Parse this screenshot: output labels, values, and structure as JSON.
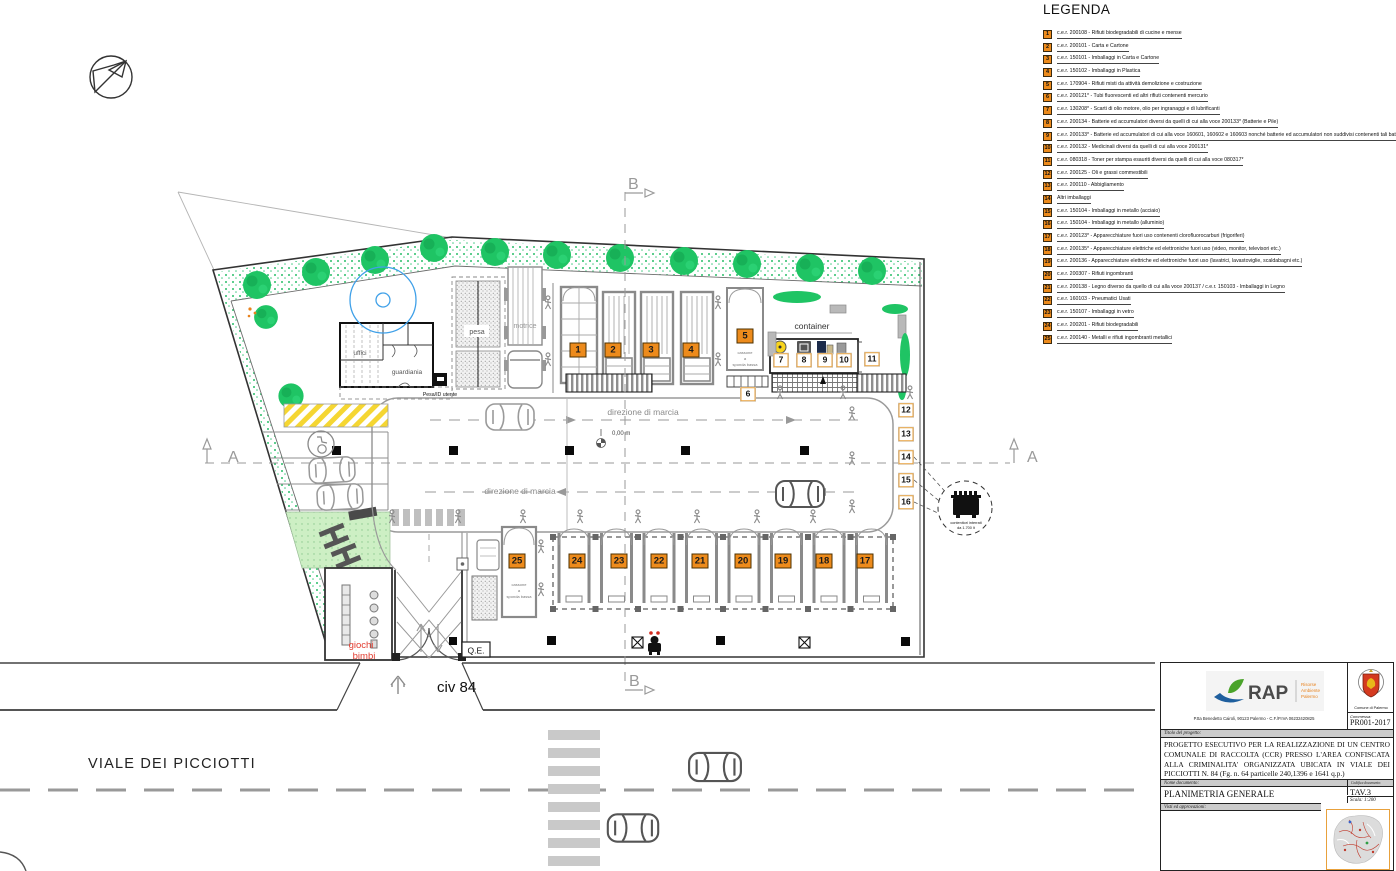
{
  "legend": {
    "title": "LEGENDA",
    "items": [
      {
        "num": "1",
        "text": "c.e.r. 200108 - Rifiuti biodegradabili di cucine e mense"
      },
      {
        "num": "2",
        "text": "c.e.r. 200101 - Carta e Cartone"
      },
      {
        "num": "3",
        "text": "c.e.r. 150101 - Imballaggi in Carta e Cartone"
      },
      {
        "num": "4",
        "text": "c.e.r. 150102 - Imballaggi in Plastica"
      },
      {
        "num": "5",
        "text": "c.e.r. 170904 - Rifiuti misti da attività demolizione e costruzione"
      },
      {
        "num": "6",
        "text": "c.e.r. 200121* - Tubi fluorescenti ed altri rifiuti contenenti mercurio"
      },
      {
        "num": "7",
        "text": "c.e.r. 130208* - Scarti di olio motore, olio per ingranaggi e di lubrificanti"
      },
      {
        "num": "8",
        "text": "c.e.r. 200134 - Batterie ed accumulatori diversi da quelli di cui alla voce 200133* (Batterie e Pile)"
      },
      {
        "num": "9",
        "text": "c.e.r. 200133* - Batterie ed accumulatori di cui alla voce 160601, 160602 e 160603 nonché batterie ed accumulatori non suddivisi contenenti tali batterie"
      },
      {
        "num": "10",
        "text": "c.e.r. 200132 - Medicinali diversi da quelli di cui alla voce 200131*"
      },
      {
        "num": "11",
        "text": "c.e.r. 080318 - Toner per stampa esauriti diversi da quelli di cui alla voce 080317*"
      },
      {
        "num": "12",
        "text": "c.e.r. 200125 - Oli e grassi commestibili"
      },
      {
        "num": "13",
        "text": "c.e.r. 200110 - Abbigliamento"
      },
      {
        "num": "14",
        "text": "Altri imballaggi"
      },
      {
        "num": "15",
        "text": "c.e.r. 150104 - Imballaggi in metallo (acciaio)"
      },
      {
        "num": "16",
        "text": "c.e.r. 150104 - Imballaggi in metallo (alluminio)"
      },
      {
        "num": "17",
        "text": "c.e.r. 200123* - Apparecchiature fuori uso contenenti clorofluorocarburi (frigoriferi)"
      },
      {
        "num": "18",
        "text": "c.e.r. 200135* - Apparecchiature elettriche ed elettroniche fuori uso (video, monitor, televisori etc.)"
      },
      {
        "num": "19",
        "text": "c.e.r. 200136 - Apparecchiature elettriche ed elettroniche fuori uso (lavatrici, lavastoviglie, scaldabagni etc.)"
      },
      {
        "num": "20",
        "text": "c.e.r. 200307 - Rifiuti ingombranti"
      },
      {
        "num": "21",
        "text": "c.e.r. 200138 - Legno diverso da quello di cui alla voce 200137 / c.e.r. 150103 - Imballaggi in Legno"
      },
      {
        "num": "22",
        "text": "c.e.r. 160103 - Pneumatici Usati"
      },
      {
        "num": "23",
        "text": "c.e.r. 150107 - Imballaggi in vetro"
      },
      {
        "num": "24",
        "text": "c.e.r. 200201 - Rifiuti biodegradabili"
      },
      {
        "num": "25",
        "text": "c.e.r. 200140 - Metalli e rifiuti ingombranti metallici"
      }
    ]
  },
  "plan": {
    "markers": [
      {
        "n": "1",
        "x": 578,
        "y": 350,
        "style": "orange"
      },
      {
        "n": "2",
        "x": 613,
        "y": 350,
        "style": "orange"
      },
      {
        "n": "3",
        "x": 651,
        "y": 350,
        "style": "orange"
      },
      {
        "n": "4",
        "x": 691,
        "y": 350,
        "style": "orange"
      },
      {
        "n": "5",
        "x": 745,
        "y": 336,
        "style": "orange"
      },
      {
        "n": "6",
        "x": 748,
        "y": 394,
        "style": "white"
      },
      {
        "n": "7",
        "x": 781,
        "y": 360,
        "style": "white"
      },
      {
        "n": "8",
        "x": 804,
        "y": 360,
        "style": "white"
      },
      {
        "n": "9",
        "x": 825,
        "y": 360,
        "style": "white"
      },
      {
        "n": "10",
        "x": 844,
        "y": 360,
        "style": "white"
      },
      {
        "n": "11",
        "x": 872,
        "y": 359,
        "style": "white"
      },
      {
        "n": "12",
        "x": 906,
        "y": 410,
        "style": "white"
      },
      {
        "n": "13",
        "x": 906,
        "y": 434,
        "style": "white"
      },
      {
        "n": "14",
        "x": 906,
        "y": 457,
        "style": "white"
      },
      {
        "n": "15",
        "x": 906,
        "y": 480,
        "style": "white"
      },
      {
        "n": "16",
        "x": 906,
        "y": 502,
        "style": "white"
      },
      {
        "n": "17",
        "x": 865,
        "y": 561,
        "style": "orange"
      },
      {
        "n": "18",
        "x": 824,
        "y": 561,
        "style": "orange"
      },
      {
        "n": "19",
        "x": 783,
        "y": 561,
        "style": "orange"
      },
      {
        "n": "20",
        "x": 743,
        "y": 561,
        "style": "orange"
      },
      {
        "n": "21",
        "x": 700,
        "y": 561,
        "style": "orange"
      },
      {
        "n": "22",
        "x": 659,
        "y": 561,
        "style": "orange"
      },
      {
        "n": "23",
        "x": 619,
        "y": 561,
        "style": "orange"
      },
      {
        "n": "24",
        "x": 577,
        "y": 561,
        "style": "orange"
      },
      {
        "n": "25",
        "x": 517,
        "y": 561,
        "style": "orange"
      }
    ],
    "labels": {
      "container": "container",
      "pesa": "pesa",
      "motrice": "motrice",
      "uffici": "uffici",
      "guardiania": "guardiania",
      "totem": "totem",
      "pesa_id": "Pesa/ID utente",
      "direzione": "direzione di marcia",
      "quota": "0,00 m",
      "cassone_l1": "cassone",
      "cassone_l2": "a",
      "cassone_l3": "sponda bassa",
      "interrati_l1": "contenitori interrati",
      "interrati_l2": "da 1.700 lt",
      "giochi_l1": "giochi",
      "giochi_l2": "bimbi",
      "qe": "Q.E.",
      "civ": "civ 84",
      "street": "VIALE DEI PICCIOTTI",
      "section_a": "A",
      "section_b": "B"
    }
  },
  "titleblock": {
    "rap": "RAP",
    "rap_sub1": "Risorse",
    "rap_sub2": "Ambiente",
    "rap_sub3": "Palermo",
    "address": "P.tta Benedetto Cairoli, 90123 Palermo - C.F./P.IVA 06232420825",
    "comune": "Comune di Palermo",
    "commessa_label": "Commessa:",
    "commessa": "PR001-2017",
    "titolo_label": "Titolo del progetto:",
    "titolo": "PROGETTO ESECUTIVO PER LA REALIZZAZIONE DI UN CENTRO COMUNALE DI RACCOLTA (CCR) PRESSO L'AREA CONFISCATA ALLA CRIMINALITA' ORGANIZZATA UBICATA IN VIALE DEI PICCIOTTI N. 84 (Fg. n. 64 particelle 240,1396 e 1641 q.p.)",
    "nome_label": "Nome documento:",
    "nome": "PLANIMETRIA GENERALE",
    "codifica_label": "Codifica documento:",
    "codifica": "TAV.3",
    "scala": "Scala: 1:200",
    "visti_label": "Visti ed approvazioni:"
  }
}
